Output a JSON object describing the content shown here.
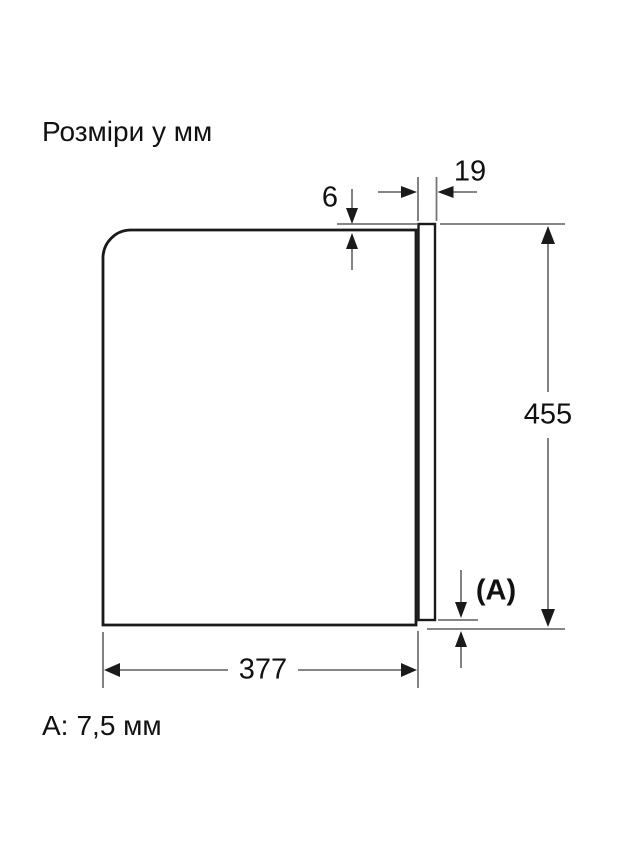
{
  "title": "Розміри у мм",
  "dimensions": {
    "top_protrusion": "6",
    "door_thickness": "19",
    "height": "455",
    "bottom_gap_ref": "(A)",
    "depth": "377"
  },
  "footnote": {
    "label": "A:",
    "value": "7,5 мм"
  },
  "colors": {
    "background": "#ffffff",
    "outline": "#1a1a1a",
    "dimension_line": "#757575",
    "arrow": "#1a1a1a",
    "text": "#111111"
  }
}
